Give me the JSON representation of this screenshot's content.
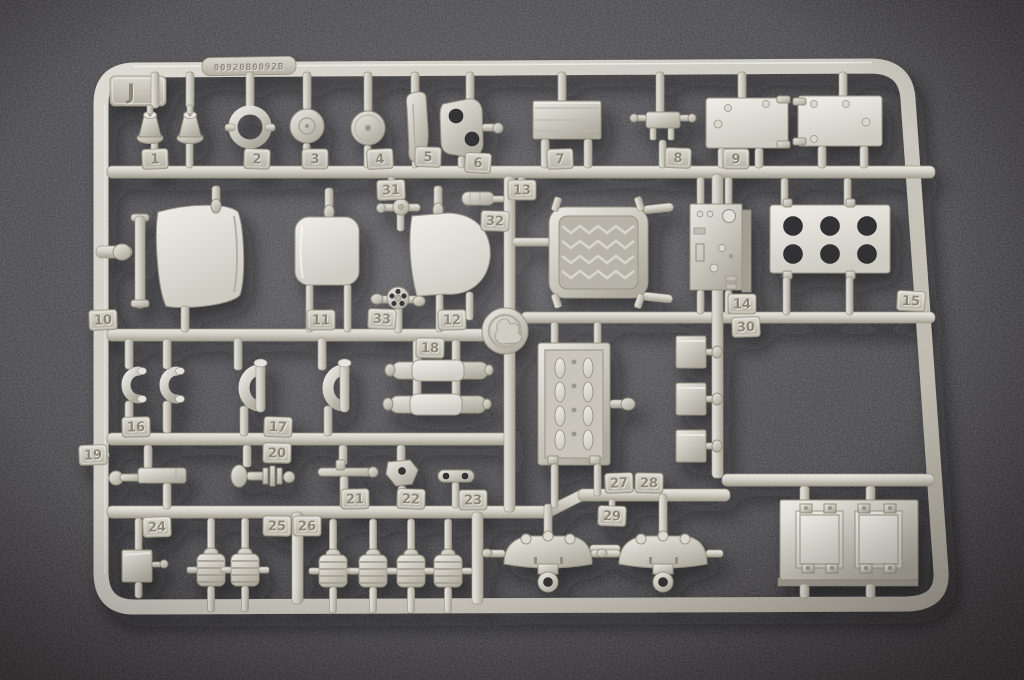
{
  "sprue": {
    "letter": "J",
    "mold_code": "00920B0092B",
    "part_numbers": [
      "1",
      "2",
      "3",
      "4",
      "5",
      "6",
      "7",
      "8",
      "9",
      "10",
      "11",
      "12",
      "13",
      "14",
      "15",
      "16",
      "17",
      "18",
      "19",
      "20",
      "21",
      "22",
      "23",
      "24",
      "25",
      "26",
      "27",
      "28",
      "29",
      "30",
      "31",
      "32",
      "33"
    ],
    "colors": {
      "plastic_highlight": "#efede7",
      "plastic_base": "#d2cfc6",
      "plastic_shadow": "#a09b8f",
      "tag_plate": "#c9c5ba",
      "embossed_digit": "#898374",
      "carpet_dark": "#363639",
      "carpet_light": "#58585c",
      "hole_dark": "#333336"
    }
  }
}
